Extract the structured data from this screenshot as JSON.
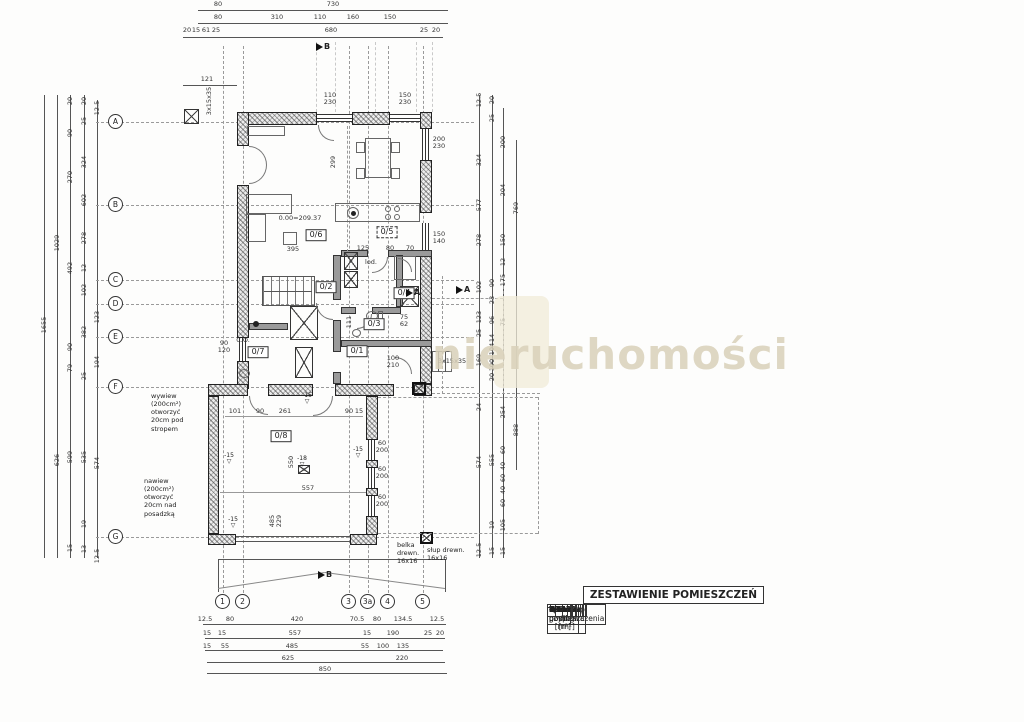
{
  "watermark": {
    "text": "nieruchomości",
    "color": "#d9d1ba"
  },
  "table": {
    "title": "ZESTAWIENIE POMIESZCZEŃ",
    "headers": [
      "Nr pomieszczenia",
      "Nazwa",
      "Pow. użytkowa [m²]",
      "Pow. podłogi [m²]"
    ],
    "rows": [
      [
        "0/1",
        "Wiatrołap",
        "5",
        "5"
      ],
      [
        "0/2",
        "Hol",
        "3.00",
        "3.00"
      ],
      [
        "0/3",
        "Łazienka",
        "2.33",
        "2.33"
      ],
      [
        "0/4",
        "Spiżarka",
        "1.61",
        "1.61"
      ],
      [
        "0/5",
        "Kuchnia",
        "7.17",
        "7.17"
      ],
      [
        "0/6",
        "Salon",
        "32.3",
        "32.3"
      ],
      [
        "0/7",
        "Pom. gosp.",
        "4",
        "8.03"
      ],
      [
        "0/8",
        "Garaż",
        "30.63",
        "30.63"
      ],
      [
        "",
        "Razem",
        "86.04",
        "90.07"
      ]
    ]
  },
  "axis_left": [
    {
      "label": "A",
      "y": 122
    },
    {
      "label": "B",
      "y": 205
    },
    {
      "label": "C",
      "y": 280
    },
    {
      "label": "D",
      "y": 304
    },
    {
      "label": "E",
      "y": 337
    },
    {
      "label": "F",
      "y": 387
    },
    {
      "label": "G",
      "y": 537
    }
  ],
  "axis_bottom": [
    {
      "label": "1",
      "x": 223
    },
    {
      "label": "2",
      "x": 243
    },
    {
      "label": "3",
      "x": 349
    },
    {
      "label": "3a",
      "x": 368
    },
    {
      "label": "4",
      "x": 388
    },
    {
      "label": "5",
      "x": 423
    }
  ],
  "section_marks": [
    {
      "t": "B",
      "x": 316,
      "y": 42
    },
    {
      "t": "B",
      "x": 318,
      "y": 570
    },
    {
      "t": "A",
      "x": 406,
      "y": 288
    },
    {
      "t": "A",
      "x": 456,
      "y": 285
    }
  ],
  "room_labels": [
    {
      "t": "0/6",
      "x": 316,
      "y": 235,
      "dashed": false
    },
    {
      "t": "0/5",
      "x": 387,
      "y": 232,
      "dashed": true
    },
    {
      "t": "0/2",
      "x": 326,
      "y": 287,
      "dashed": false
    },
    {
      "t": "0/3",
      "x": 374,
      "y": 324,
      "dashed": false
    },
    {
      "t": "0/4",
      "x": 404,
      "y": 293,
      "dashed": false
    },
    {
      "t": "0/7",
      "x": 258,
      "y": 352,
      "dashed": false
    },
    {
      "t": "0/1",
      "x": 357,
      "y": 351,
      "dashed": false
    },
    {
      "t": "0/8",
      "x": 281,
      "y": 436,
      "dashed": false
    }
  ],
  "window_labels": [
    {
      "t": "110\n230",
      "x": 330,
      "y": 92
    },
    {
      "t": "150\n230",
      "x": 405,
      "y": 92
    },
    {
      "t": "200\n230",
      "x": 439,
      "y": 136
    },
    {
      "t": "150\n140",
      "x": 439,
      "y": 231
    },
    {
      "t": "90\n120",
      "x": 224,
      "y": 340
    },
    {
      "t": "60\n200",
      "x": 382,
      "y": 440
    },
    {
      "t": "60\n200",
      "x": 382,
      "y": 466
    },
    {
      "t": "60\n200",
      "x": 382,
      "y": 494
    },
    {
      "t": "100\n210",
      "x": 393,
      "y": 355
    },
    {
      "t": "75\n62",
      "x": 404,
      "y": 314
    }
  ],
  "level_marks": [
    {
      "t": "-15\n▽",
      "x": 229,
      "y": 453
    },
    {
      "t": "-15\n▽",
      "x": 307,
      "y": 393
    },
    {
      "t": "-15\n▽",
      "x": 358,
      "y": 447
    },
    {
      "t": "-15\n▽",
      "x": 233,
      "y": 517
    },
    {
      "t": "-18\n▽",
      "x": 302,
      "y": 456
    }
  ],
  "annotations": [
    {
      "lines": [
        "wywiew",
        "(200cm²)",
        "otworzyć",
        "20cm pod",
        "stropem"
      ],
      "x": 151,
      "y": 392
    },
    {
      "lines": [
        "nawiew",
        "(200cm²)",
        "otworzyć",
        "20cm nad",
        "posadzką"
      ],
      "x": 144,
      "y": 477
    },
    {
      "lines": [
        "belka",
        "drewn.",
        "16x16"
      ],
      "x": 397,
      "y": 541
    },
    {
      "lines": [
        "słup drewn.",
        "16x16"
      ],
      "x": 427,
      "y": 546
    }
  ],
  "texts": [
    {
      "t": "80",
      "x": 218,
      "y": 4
    },
    {
      "t": "730",
      "x": 333,
      "y": 4
    },
    {
      "t": "80",
      "x": 218,
      "y": 17
    },
    {
      "t": "310",
      "x": 277,
      "y": 17
    },
    {
      "t": "110",
      "x": 320,
      "y": 17
    },
    {
      "t": "160",
      "x": 353,
      "y": 17
    },
    {
      "t": "150",
      "x": 390,
      "y": 17
    },
    {
      "t": "20",
      "x": 187,
      "y": 30
    },
    {
      "t": "15",
      "x": 196,
      "y": 30
    },
    {
      "t": "61",
      "x": 206,
      "y": 30
    },
    {
      "t": "25",
      "x": 216,
      "y": 30
    },
    {
      "t": "680",
      "x": 331,
      "y": 30
    },
    {
      "t": "25",
      "x": 424,
      "y": 30
    },
    {
      "t": "20",
      "x": 436,
      "y": 30
    },
    {
      "t": "121",
      "x": 207,
      "y": 79
    },
    {
      "t": "1655",
      "x": 44,
      "y": 325,
      "r": 1
    },
    {
      "t": "1029",
      "x": 57,
      "y": 243,
      "r": 1
    },
    {
      "t": "626",
      "x": 57,
      "y": 460,
      "r": 1
    },
    {
      "t": "20",
      "x": 70,
      "y": 101,
      "r": 1
    },
    {
      "t": "90",
      "x": 70,
      "y": 133,
      "r": 1
    },
    {
      "t": "270",
      "x": 70,
      "y": 177,
      "r": 1
    },
    {
      "t": "492",
      "x": 70,
      "y": 268,
      "r": 1
    },
    {
      "t": "90",
      "x": 70,
      "y": 347,
      "r": 1
    },
    {
      "t": "79",
      "x": 70,
      "y": 368,
      "r": 1
    },
    {
      "t": "599",
      "x": 70,
      "y": 457,
      "r": 1
    },
    {
      "t": "15",
      "x": 70,
      "y": 548,
      "r": 1
    },
    {
      "t": "20",
      "x": 84,
      "y": 101,
      "r": 1
    },
    {
      "t": "25",
      "x": 84,
      "y": 121,
      "r": 1
    },
    {
      "t": "324",
      "x": 84,
      "y": 162,
      "r": 1
    },
    {
      "t": "602",
      "x": 84,
      "y": 200,
      "r": 1
    },
    {
      "t": "278",
      "x": 84,
      "y": 238,
      "r": 1
    },
    {
      "t": "12",
      "x": 84,
      "y": 268,
      "r": 1
    },
    {
      "t": "102",
      "x": 84,
      "y": 290,
      "r": 1
    },
    {
      "t": "382",
      "x": 84,
      "y": 332,
      "r": 1
    },
    {
      "t": "25",
      "x": 84,
      "y": 376,
      "r": 1
    },
    {
      "t": "535",
      "x": 84,
      "y": 457,
      "r": 1
    },
    {
      "t": "19",
      "x": 84,
      "y": 524,
      "r": 1
    },
    {
      "t": "13",
      "x": 84,
      "y": 549,
      "r": 1
    },
    {
      "t": "12.5",
      "x": 97,
      "y": 108,
      "r": 1
    },
    {
      "t": "123",
      "x": 97,
      "y": 317,
      "r": 1
    },
    {
      "t": "194",
      "x": 97,
      "y": 362,
      "r": 1
    },
    {
      "t": "574",
      "x": 97,
      "y": 463,
      "r": 1
    },
    {
      "t": "12.5",
      "x": 97,
      "y": 556,
      "r": 1
    },
    {
      "t": "12.5",
      "x": 479,
      "y": 100,
      "r": 1
    },
    {
      "t": "324",
      "x": 479,
      "y": 160,
      "r": 1
    },
    {
      "t": "577",
      "x": 479,
      "y": 205,
      "r": 1
    },
    {
      "t": "278",
      "x": 479,
      "y": 240,
      "r": 1
    },
    {
      "t": "102",
      "x": 479,
      "y": 287,
      "r": 1
    },
    {
      "t": "123",
      "x": 479,
      "y": 317,
      "r": 1
    },
    {
      "t": "25",
      "x": 479,
      "y": 333,
      "r": 1
    },
    {
      "t": "169",
      "x": 479,
      "y": 360,
      "r": 1
    },
    {
      "t": "24",
      "x": 479,
      "y": 407,
      "r": 1
    },
    {
      "t": "574",
      "x": 479,
      "y": 462,
      "r": 1
    },
    {
      "t": "12.5",
      "x": 479,
      "y": 550,
      "r": 1
    },
    {
      "t": "20",
      "x": 492,
      "y": 100,
      "r": 1
    },
    {
      "t": "25",
      "x": 492,
      "y": 118,
      "r": 1
    },
    {
      "t": "90",
      "x": 492,
      "y": 283,
      "r": 1
    },
    {
      "t": "23",
      "x": 492,
      "y": 300,
      "r": 1
    },
    {
      "t": "96",
      "x": 492,
      "y": 320,
      "r": 1
    },
    {
      "t": "14",
      "x": 492,
      "y": 338,
      "r": 1
    },
    {
      "t": "104",
      "x": 492,
      "y": 349,
      "r": 1
    },
    {
      "t": "100",
      "x": 492,
      "y": 365,
      "r": 1
    },
    {
      "t": "20",
      "x": 492,
      "y": 377,
      "r": 1
    },
    {
      "t": "555",
      "x": 492,
      "y": 460,
      "r": 1
    },
    {
      "t": "19",
      "x": 492,
      "y": 525,
      "r": 1
    },
    {
      "t": "15",
      "x": 492,
      "y": 551,
      "r": 1
    },
    {
      "t": "200",
      "x": 503,
      "y": 142,
      "r": 1
    },
    {
      "t": "204",
      "x": 503,
      "y": 190,
      "r": 1
    },
    {
      "t": "150",
      "x": 503,
      "y": 240,
      "r": 1
    },
    {
      "t": "12",
      "x": 503,
      "y": 262,
      "r": 1
    },
    {
      "t": "175",
      "x": 503,
      "y": 280,
      "r": 1
    },
    {
      "t": "75",
      "x": 503,
      "y": 322,
      "r": 1
    },
    {
      "t": "254",
      "x": 503,
      "y": 412,
      "r": 1
    },
    {
      "t": "60",
      "x": 503,
      "y": 450,
      "r": 1
    },
    {
      "t": "40",
      "x": 503,
      "y": 466,
      "r": 1
    },
    {
      "t": "60",
      "x": 503,
      "y": 478,
      "r": 1
    },
    {
      "t": "40",
      "x": 503,
      "y": 490,
      "r": 1
    },
    {
      "t": "60",
      "x": 503,
      "y": 503,
      "r": 1
    },
    {
      "t": "105",
      "x": 503,
      "y": 525,
      "r": 1
    },
    {
      "t": "15",
      "x": 503,
      "y": 551,
      "r": 1
    },
    {
      "t": "769",
      "x": 516,
      "y": 208,
      "r": 1
    },
    {
      "t": "888",
      "x": 516,
      "y": 430,
      "r": 1
    },
    {
      "t": "12.5",
      "x": 205,
      "y": 619
    },
    {
      "t": "80",
      "x": 230,
      "y": 619
    },
    {
      "t": "420",
      "x": 297,
      "y": 619
    },
    {
      "t": "70.5",
      "x": 357,
      "y": 619
    },
    {
      "t": "80",
      "x": 377,
      "y": 619
    },
    {
      "t": "134.5",
      "x": 403,
      "y": 619
    },
    {
      "t": "12.5",
      "x": 437,
      "y": 619
    },
    {
      "t": "15",
      "x": 207,
      "y": 633
    },
    {
      "t": "15",
      "x": 222,
      "y": 633
    },
    {
      "t": "557",
      "x": 295,
      "y": 633
    },
    {
      "t": "15",
      "x": 367,
      "y": 633
    },
    {
      "t": "190",
      "x": 393,
      "y": 633
    },
    {
      "t": "25",
      "x": 428,
      "y": 633
    },
    {
      "t": "20",
      "x": 440,
      "y": 633
    },
    {
      "t": "15",
      "x": 207,
      "y": 646
    },
    {
      "t": "55",
      "x": 225,
      "y": 646
    },
    {
      "t": "485",
      "x": 292,
      "y": 646
    },
    {
      "t": "55",
      "x": 365,
      "y": 646
    },
    {
      "t": "100",
      "x": 383,
      "y": 646
    },
    {
      "t": "135",
      "x": 403,
      "y": 646
    },
    {
      "t": "625",
      "x": 288,
      "y": 658
    },
    {
      "t": "220",
      "x": 402,
      "y": 658
    },
    {
      "t": "850",
      "x": 325,
      "y": 669
    },
    {
      "t": "0.00=209.37",
      "x": 300,
      "y": 218
    },
    {
      "t": "395",
      "x": 293,
      "y": 249
    },
    {
      "t": "299",
      "x": 333,
      "y": 162,
      "r": 1
    },
    {
      "t": "101",
      "x": 235,
      "y": 411
    },
    {
      "t": "90",
      "x": 260,
      "y": 411
    },
    {
      "t": "261",
      "x": 285,
      "y": 411
    },
    {
      "t": "90",
      "x": 349,
      "y": 411
    },
    {
      "t": "15",
      "x": 359,
      "y": 411
    },
    {
      "t": "550",
      "x": 291,
      "y": 462,
      "r": 1
    },
    {
      "t": "557",
      "x": 308,
      "y": 488
    },
    {
      "t": "485",
      "x": 272,
      "y": 521,
      "r": 1
    },
    {
      "t": "229",
      "x": 279,
      "y": 521,
      "r": 1
    },
    {
      "t": "125",
      "x": 363,
      "y": 248
    },
    {
      "t": "80",
      "x": 390,
      "y": 248
    },
    {
      "t": "70",
      "x": 410,
      "y": 248
    },
    {
      "t": "111",
      "x": 349,
      "y": 322,
      "r": 1
    },
    {
      "t": "3x15x35",
      "x": 209,
      "y": 101,
      "r": 1
    },
    {
      "t": "3x15x35",
      "x": 452,
      "y": 361
    },
    {
      "t": "lod.",
      "x": 371,
      "y": 262
    },
    {
      "t": "C.O.",
      "x": 243,
      "y": 340
    }
  ]
}
